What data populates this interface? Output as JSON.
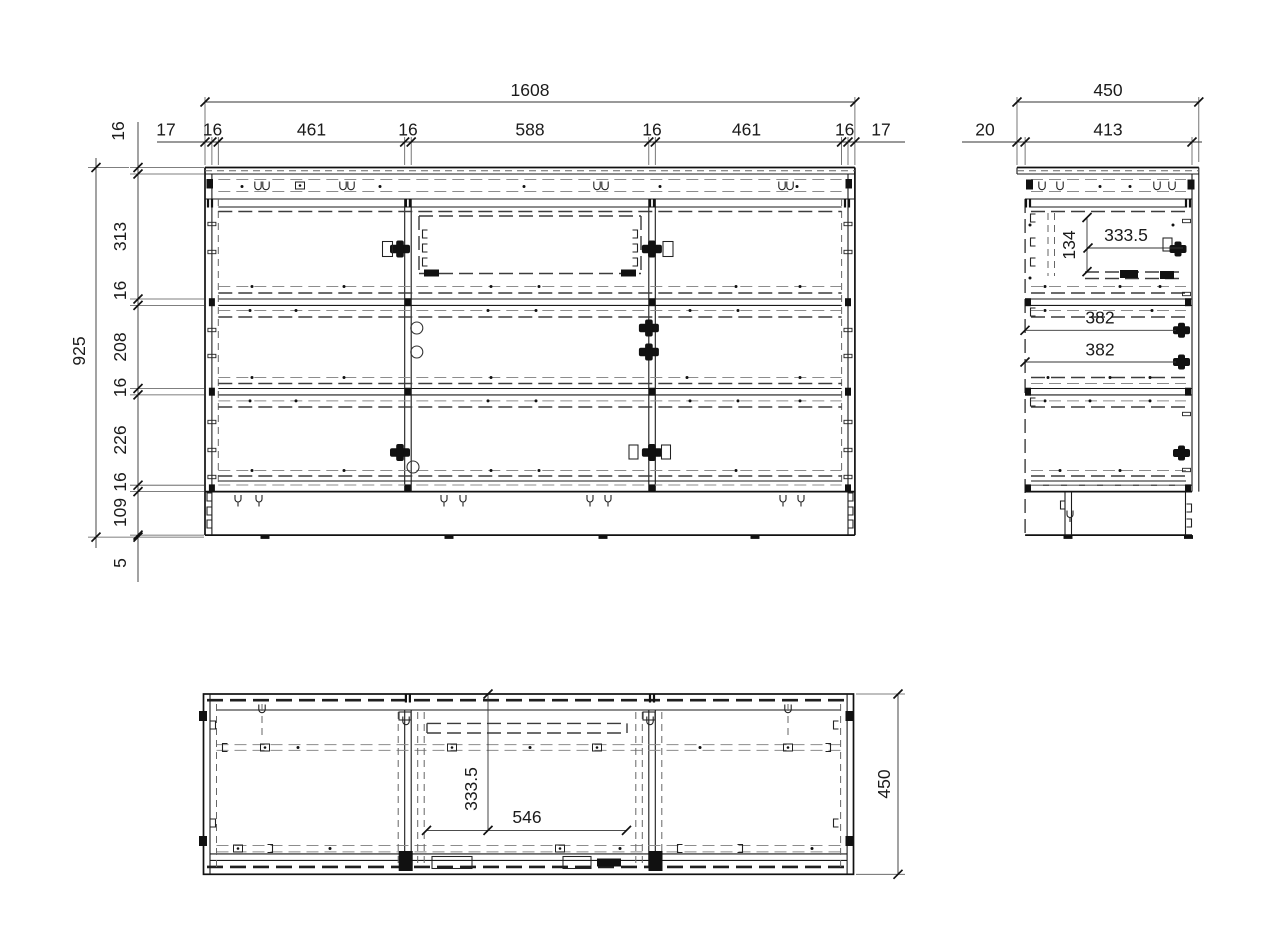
{
  "front_view": {
    "overall_width": "1608",
    "width_chain": [
      "17",
      "16",
      "461",
      "16",
      "588",
      "16",
      "461",
      "16",
      "17"
    ],
    "top_panel_thickness": "16",
    "overall_height": "925",
    "height_chain": [
      "313",
      "16",
      "208",
      "16",
      "226",
      "16",
      "109",
      "5"
    ]
  },
  "side_view": {
    "overall_depth": "450",
    "back_gap": "20",
    "carcass_depth": "413",
    "drawer_height": "134",
    "drawer_depth": "333.5",
    "hinge_dims": [
      "382",
      "382"
    ]
  },
  "top_view": {
    "opening_depth": "333.5",
    "opening_width": "546",
    "overall_depth": "450"
  }
}
